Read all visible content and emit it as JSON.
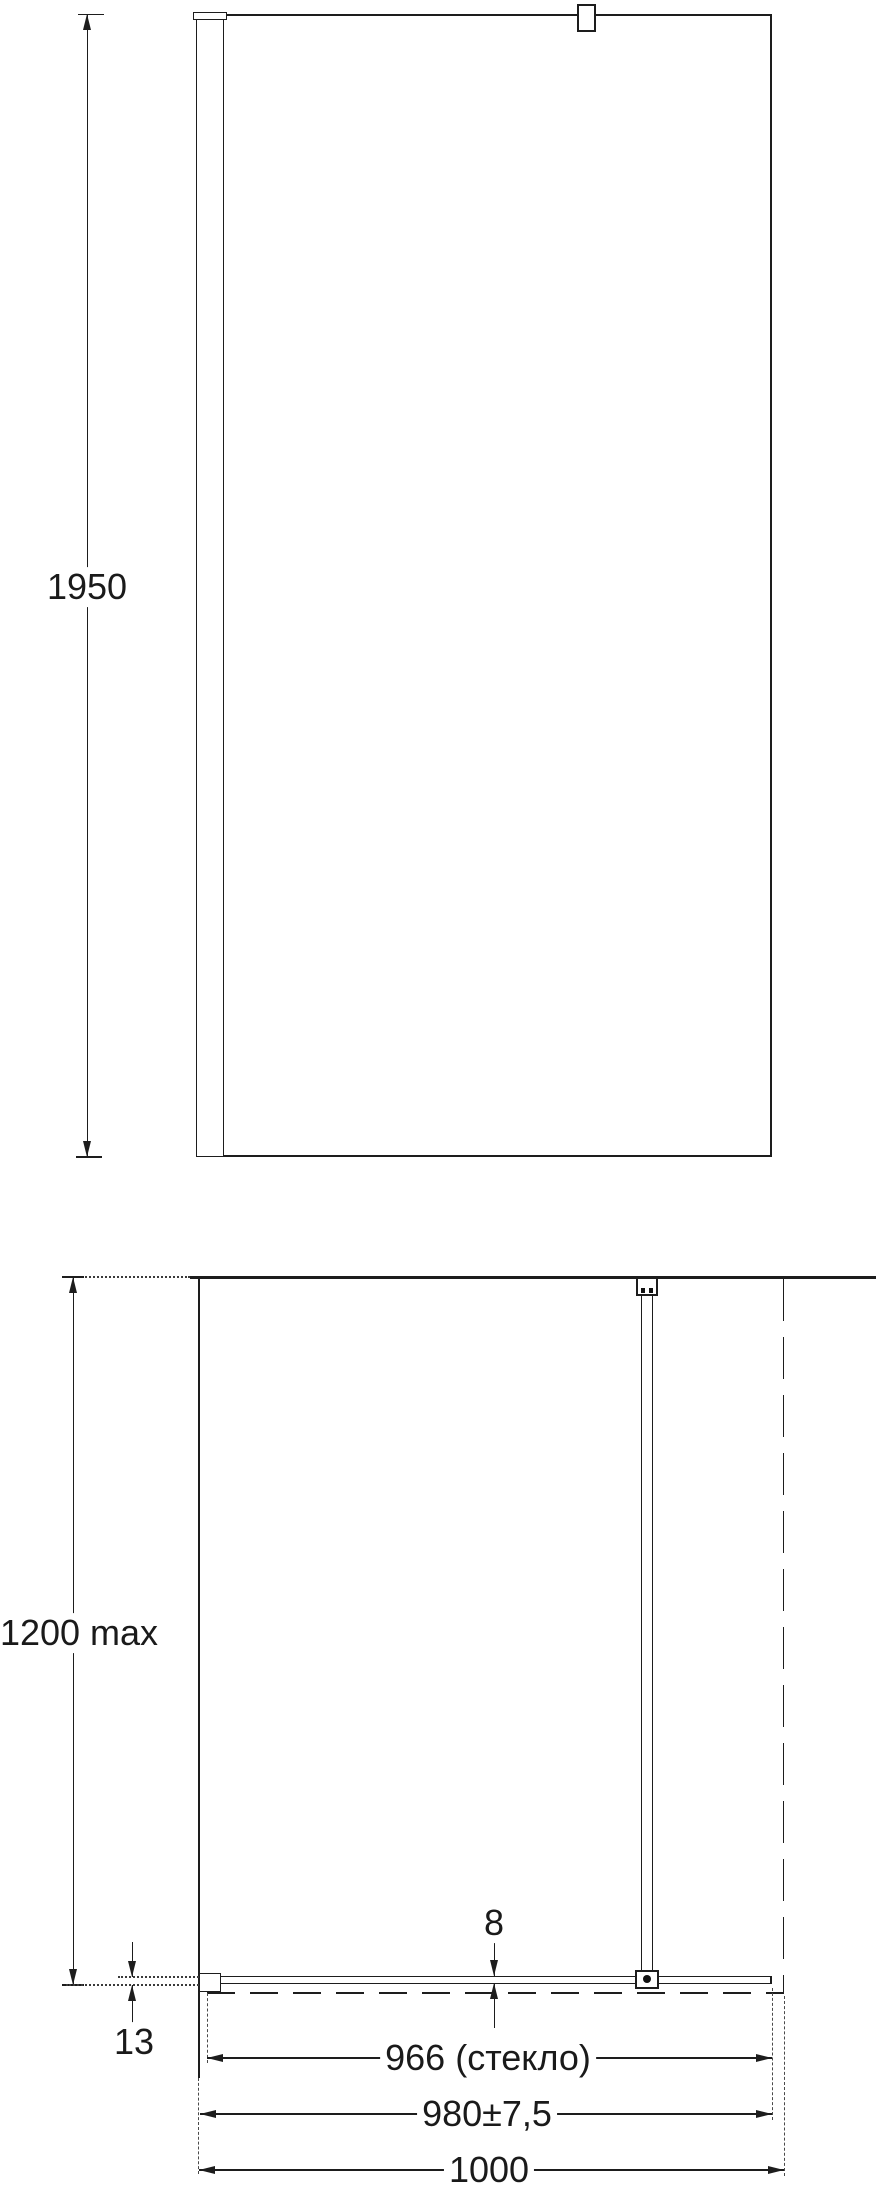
{
  "drawing": {
    "front_view": {
      "height_dim": "1950"
    },
    "plan_view": {
      "depth_max_dim": "1200 max",
      "wall_offset_dim": "13",
      "glass_thickness_dim": "8",
      "glass_width_dim": "966 (стекло)",
      "adjustment_width_dim": "980±7,5",
      "total_width_dim": "1000"
    }
  },
  "colors": {
    "line": "#1d1d1d",
    "background": "#ffffff",
    "text": "#1a1a1a"
  }
}
